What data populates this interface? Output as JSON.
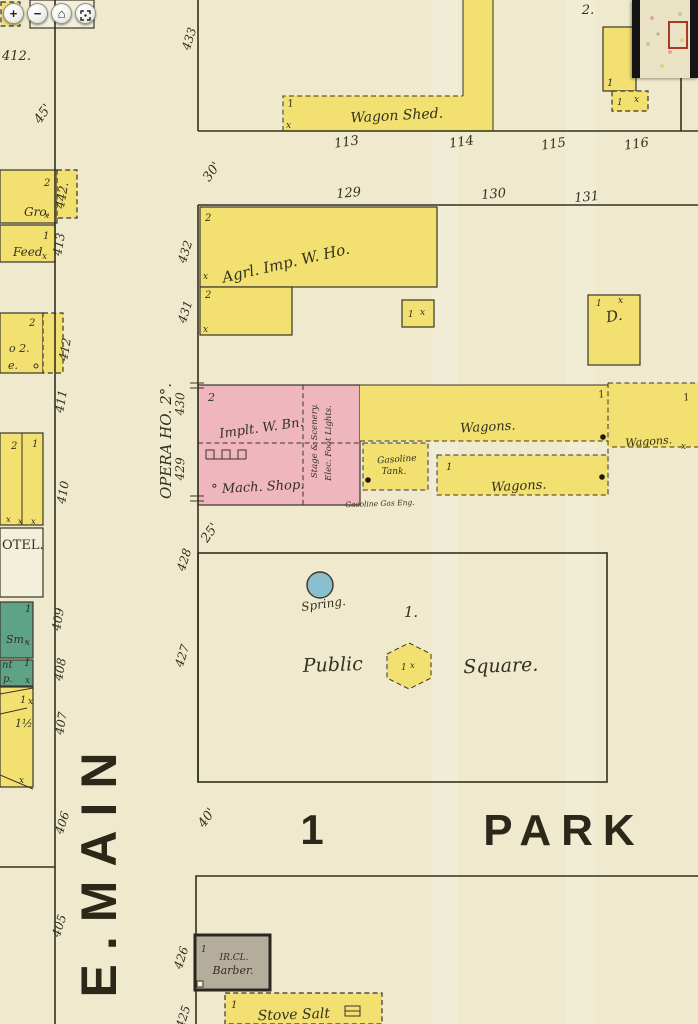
{
  "viewer": {
    "zoom_in": "+",
    "zoom_out": "−",
    "home": "⌂",
    "fullscreen": "⛶"
  },
  "colors": {
    "paper": "#efe9cd",
    "paper-light": "#f3efda",
    "yellow": "#f2e170",
    "pink": "#efb6bf",
    "green": "#5ea287",
    "gray": "#b5ad9c",
    "blue": "#8abfcf",
    "ink": "#33301f",
    "mm-bar": "#141414",
    "mm-sheet": "#e9e2c4",
    "mm-viewport": "#a83a22"
  },
  "streets": {
    "e_main": "E.MAIN",
    "park": "PARK",
    "park_block_number": "1"
  },
  "dimensions": {
    "d45": "45'",
    "d30": "30'",
    "d25": "25'",
    "d40": "40'"
  },
  "lots": {
    "top_row": [
      "113",
      "114",
      "115",
      "116"
    ],
    "second_row": [
      "129",
      "130",
      "131"
    ],
    "east_side": [
      "433",
      "432",
      "431",
      "430",
      "429",
      "428",
      "427"
    ],
    "west_side": [
      "442.",
      "413",
      "412",
      "411",
      "410",
      "409",
      "408",
      "407",
      "406",
      "405"
    ],
    "south": [
      "426",
      "425"
    ],
    "top_left_partial": "412.",
    "outlot": "2."
  },
  "buildings": {
    "wagon_shed": "Wagon Shed.",
    "agrl_imp": "Agrl. Imp. W. Ho.",
    "dwelling": "D.",
    "opera_house": "OPERA HO. 2°.",
    "implement": "Implt. W. Bn.",
    "mach_shop": "° Mach. Shop.",
    "stage_1": "Stage & Scenery.",
    "stage_2": "Elec. Foot Lights.",
    "gasoline_1": "Gasoline",
    "gasoline_2": "Tank.",
    "gas_engine": "Gasoline Gas Eng.",
    "wagons": "Wagons.",
    "gro": "Gro.",
    "feed": "Feed",
    "store_1": "o 2.",
    "store_2": "e.",
    "hotel": "OTEL.",
    "smith": "Sm.",
    "paint_1": "nt",
    "paint_2": "p.",
    "barn_stories": "1½",
    "barber_1": "IR.CL.",
    "barber_2": "Barber.",
    "stove_salt": "Stove Salt"
  },
  "square": {
    "label_left": "Public",
    "label_right": "Square.",
    "block_number": "1.",
    "spring": "Spring."
  },
  "marks": {
    "x": "x",
    "one": "1",
    "two": "2"
  }
}
